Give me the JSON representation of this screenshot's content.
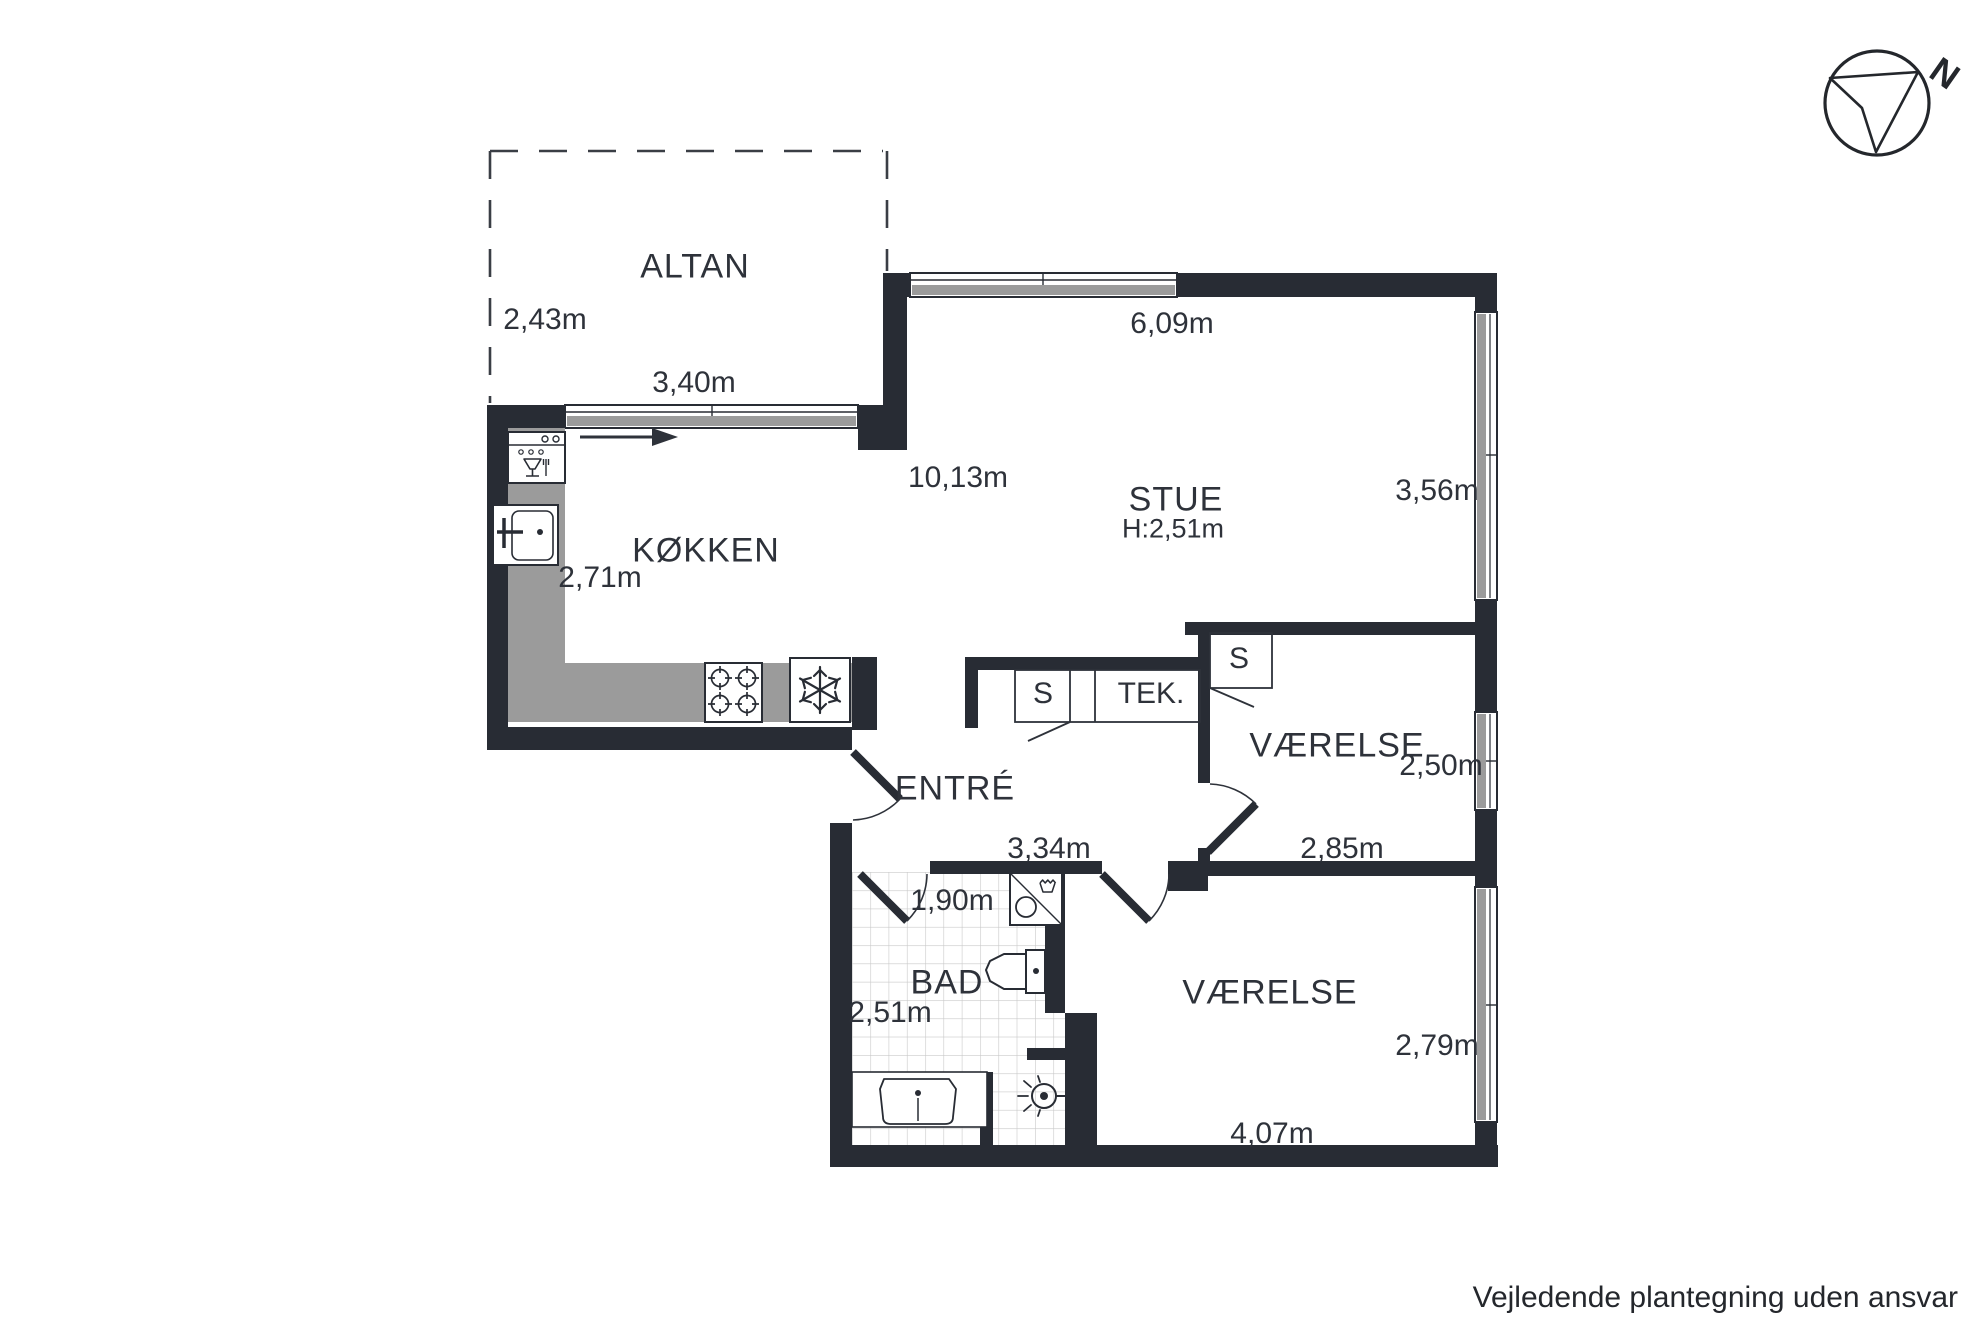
{
  "plan": {
    "compass": {
      "north_label": "N"
    },
    "disclaimer": "Vejledende plantegning uden ansvar",
    "colors": {
      "wall": "#282c34",
      "text": "#2e323a",
      "counter": "#9b9b9b",
      "window_sill": "#9b9b9b",
      "tile_line": "#c9c9c9"
    },
    "rooms": [
      {
        "name": "ALTAN",
        "dimensions": [
          "2,43m",
          "3,40m"
        ]
      },
      {
        "name": "KØKKEN",
        "dimensions": [
          "2,71m"
        ]
      },
      {
        "name": "STUE",
        "ceiling_height": "H:2,51m",
        "dimensions": [
          "6,09m",
          "10,13m",
          "3,56m"
        ]
      },
      {
        "name": "ENTRÉ",
        "dimensions": [
          "3,34m"
        ]
      },
      {
        "name": "TEK.",
        "closet_labels": [
          "S",
          "S"
        ]
      },
      {
        "name": "VÆRELSE",
        "dimensions": [
          "2,50m",
          "2,85m"
        ]
      },
      {
        "name": "BAD",
        "dimensions": [
          "1,90m",
          "2,51m"
        ]
      },
      {
        "name": "VÆRELSE",
        "dimensions": [
          "2,79m",
          "4,07m"
        ]
      }
    ],
    "labels": [
      {
        "name": "room-label-altan",
        "text": "ALTAN",
        "kind": "room",
        "x": 695,
        "y": 267
      },
      {
        "name": "dim-altan-depth",
        "text": "2,43m",
        "kind": "dim",
        "x": 545,
        "y": 320
      },
      {
        "name": "dim-altan-width",
        "text": "3,40m",
        "kind": "dim",
        "x": 694,
        "y": 383
      },
      {
        "name": "dim-stue-width",
        "text": "6,09m",
        "kind": "dim",
        "x": 1172,
        "y": 324
      },
      {
        "name": "dim-stue-length",
        "text": "10,13m",
        "kind": "dim",
        "x": 958,
        "y": 478
      },
      {
        "name": "room-label-stue",
        "text": "STUE",
        "kind": "room",
        "x": 1176,
        "y": 500
      },
      {
        "name": "ceiling-height-stue",
        "text": "H:2,51m",
        "kind": "small",
        "x": 1173,
        "y": 529
      },
      {
        "name": "dim-stue-depth",
        "text": "3,56m",
        "kind": "dim",
        "x": 1437,
        "y": 491
      },
      {
        "name": "room-label-kokken",
        "text": "KØKKEN",
        "kind": "room",
        "x": 706,
        "y": 551
      },
      {
        "name": "dim-kokken-width",
        "text": "2,71m",
        "kind": "dim",
        "x": 600,
        "y": 578
      },
      {
        "name": "closet-label-s-entre",
        "text": "S",
        "kind": "closet",
        "x": 1043,
        "y": 694
      },
      {
        "name": "closet-label-tek",
        "text": "TEK.",
        "kind": "closet",
        "x": 1151,
        "y": 694
      },
      {
        "name": "closet-label-s-vaerelse",
        "text": "S",
        "kind": "closet",
        "x": 1239,
        "y": 659
      },
      {
        "name": "room-label-vaerelse-top",
        "text": "VÆRELSE",
        "kind": "room",
        "x": 1337,
        "y": 746
      },
      {
        "name": "dim-vaerelse-top-depth",
        "text": "2,50m",
        "kind": "dim",
        "x": 1441,
        "y": 766
      },
      {
        "name": "room-label-entre",
        "text": "ENTRÉ",
        "kind": "room",
        "x": 955,
        "y": 789
      },
      {
        "name": "dim-vaerelse-top-width",
        "text": "2,85m",
        "kind": "dim",
        "x": 1342,
        "y": 849
      },
      {
        "name": "dim-entre-width",
        "text": "3,34m",
        "kind": "dim",
        "x": 1049,
        "y": 849
      },
      {
        "name": "dim-bad-width",
        "text": "1,90m",
        "kind": "dim",
        "x": 952,
        "y": 901
      },
      {
        "name": "room-label-bad",
        "text": "BAD",
        "kind": "room",
        "x": 947,
        "y": 983
      },
      {
        "name": "dim-bad-depth",
        "text": "2,51m",
        "kind": "dim",
        "x": 890,
        "y": 1013
      },
      {
        "name": "room-label-vaerelse-bottom",
        "text": "VÆRELSE",
        "kind": "room",
        "x": 1270,
        "y": 993
      },
      {
        "name": "dim-vaerelse-bottom-depth",
        "text": "2,79m",
        "kind": "dim",
        "x": 1437,
        "y": 1046
      },
      {
        "name": "dim-vaerelse-bottom-width",
        "text": "4,07m",
        "kind": "dim",
        "x": 1272,
        "y": 1134
      }
    ]
  }
}
